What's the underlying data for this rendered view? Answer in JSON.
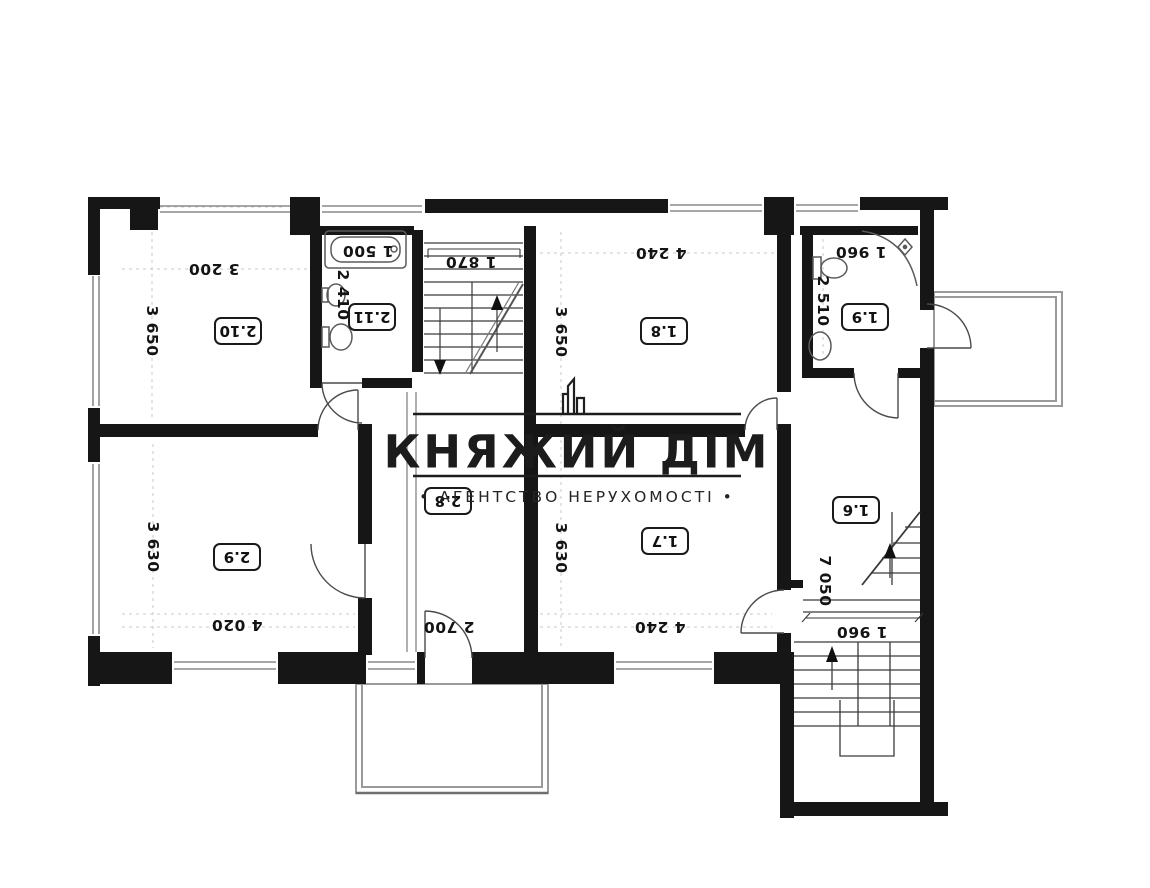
{
  "watermark": {
    "title": "КНЯЖИЙ ДІМ",
    "subtitle": "• АГЕНТСТВО НЕРУХОМОСТІ •",
    "logo_icon": "building-skyline-icon"
  },
  "rooms": {
    "r210": {
      "number": "2.10",
      "width": "3 200",
      "depth": "3 650"
    },
    "r211": {
      "number": "2.11",
      "width": "1 500",
      "depth": "2 410"
    },
    "r18": {
      "number": "1.8",
      "width": "4 240",
      "depth": "3 650"
    },
    "r19": {
      "number": "1.9",
      "width": "1 960",
      "depth": "2 510"
    },
    "r29": {
      "number": "2.9",
      "width": "4 020",
      "depth": "3 630"
    },
    "r28": {
      "number": "2.8",
      "width": "2 700"
    },
    "r17": {
      "number": "1.7",
      "width": "4 240",
      "depth": "3 630"
    },
    "r16": {
      "number": "1.6",
      "depth": "7 050"
    }
  },
  "stairs": {
    "upper": {
      "width": "1 870"
    },
    "lower": {
      "width": "1 960"
    }
  },
  "colors": {
    "wall": "#161616",
    "thin_line": "#3a3a3a",
    "light_outline": "#9a9a9a",
    "ink": "#141414",
    "watermark": "#1c1c1c",
    "background": "#ffffff"
  }
}
